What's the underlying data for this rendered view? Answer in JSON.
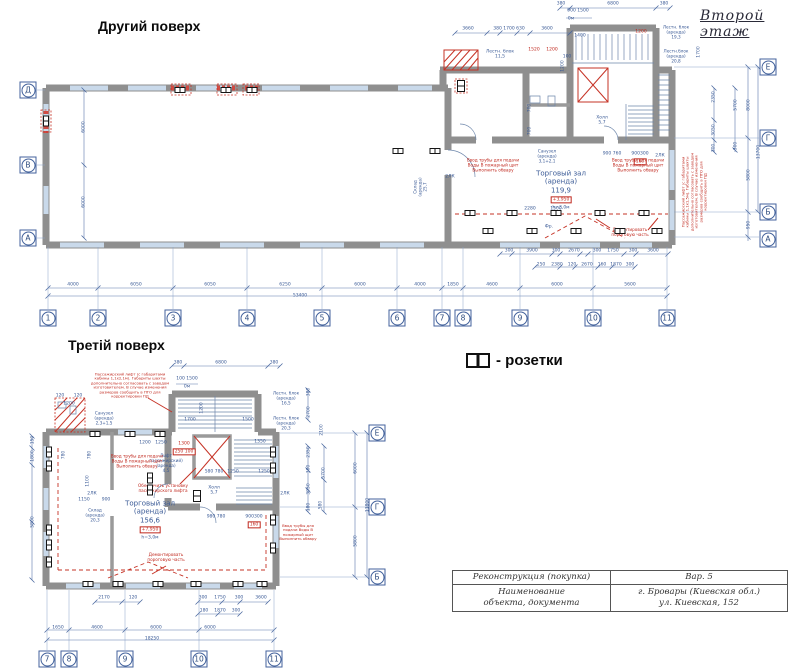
{
  "page": {
    "upper_title": "Другий поверх",
    "floor_note": "Второй этаж",
    "lower_title": "Третій поверх"
  },
  "legend": {
    "symbol": "socket-icon",
    "label": "- розетки"
  },
  "title_block": {
    "doc_type": "Реконструкция (покупка)",
    "doc_caption_1": "Наименование",
    "doc_caption_2": "объекта, документа",
    "variant": "Вар. 5",
    "address_1": "г. Бровары (Киевская обл.)",
    "address_2": "ул. Киевская, 152"
  },
  "colors": {
    "dim_blue": "#3a5a96",
    "annotation_red": "#c0281e",
    "wall_gray": "#8f8f8f",
    "window_blue": "#c9d9ea"
  },
  "axes": [
    {
      "l": "Д",
      "x": 28,
      "y": 90
    },
    {
      "l": "В",
      "x": 28,
      "y": 165
    },
    {
      "l": "А",
      "x": 28,
      "y": 238
    },
    {
      "l": "Е",
      "x": 768,
      "y": 67
    },
    {
      "l": "Г",
      "x": 768,
      "y": 138
    },
    {
      "l": "Б",
      "x": 768,
      "y": 212
    },
    {
      "l": "А",
      "x": 768,
      "y": 239
    },
    {
      "l": "1",
      "x": 48,
      "y": 318
    },
    {
      "l": "2",
      "x": 98,
      "y": 318
    },
    {
      "l": "3",
      "x": 173,
      "y": 318
    },
    {
      "l": "4",
      "x": 247,
      "y": 318
    },
    {
      "l": "5",
      "x": 322,
      "y": 318
    },
    {
      "l": "6",
      "x": 397,
      "y": 318
    },
    {
      "l": "7",
      "x": 442,
      "y": 318
    },
    {
      "l": "8",
      "x": 463,
      "y": 318
    },
    {
      "l": "9",
      "x": 520,
      "y": 318
    },
    {
      "l": "10",
      "x": 593,
      "y": 318
    },
    {
      "l": "11",
      "x": 667,
      "y": 318
    },
    {
      "l": "Е",
      "x": 377,
      "y": 433
    },
    {
      "l": "Г",
      "x": 377,
      "y": 507
    },
    {
      "l": "Б",
      "x": 377,
      "y": 577
    },
    {
      "l": "7",
      "x": 47,
      "y": 659
    },
    {
      "l": "8",
      "x": 69,
      "y": 659
    },
    {
      "l": "9",
      "x": 125,
      "y": 659
    },
    {
      "l": "10",
      "x": 199,
      "y": 659
    },
    {
      "l": "11",
      "x": 274,
      "y": 659
    }
  ],
  "sockets": [
    {
      "x": 180,
      "y": 90
    },
    {
      "x": 226,
      "y": 90
    },
    {
      "x": 252,
      "y": 90
    },
    {
      "x": 46,
      "y": 121,
      "r": 90
    },
    {
      "x": 398,
      "y": 151
    },
    {
      "x": 435,
      "y": 151
    },
    {
      "x": 461,
      "y": 86,
      "r": 90,
      "b": 1
    },
    {
      "x": 470,
      "y": 213
    },
    {
      "x": 512,
      "y": 213
    },
    {
      "x": 556,
      "y": 213
    },
    {
      "x": 600,
      "y": 213
    },
    {
      "x": 644,
      "y": 213
    },
    {
      "x": 488,
      "y": 231
    },
    {
      "x": 532,
      "y": 231
    },
    {
      "x": 576,
      "y": 231
    },
    {
      "x": 620,
      "y": 231
    },
    {
      "x": 657,
      "y": 231
    },
    {
      "x": 95,
      "y": 434
    },
    {
      "x": 130,
      "y": 434
    },
    {
      "x": 160,
      "y": 434
    },
    {
      "x": 49,
      "y": 452,
      "r": 90
    },
    {
      "x": 49,
      "y": 466,
      "r": 90
    },
    {
      "x": 49,
      "y": 530,
      "r": 90
    },
    {
      "x": 49,
      "y": 545,
      "r": 90
    },
    {
      "x": 49,
      "y": 562,
      "r": 90
    },
    {
      "x": 88,
      "y": 584
    },
    {
      "x": 118,
      "y": 584
    },
    {
      "x": 158,
      "y": 584
    },
    {
      "x": 196,
      "y": 584
    },
    {
      "x": 238,
      "y": 584
    },
    {
      "x": 262,
      "y": 584
    },
    {
      "x": 273,
      "y": 452,
      "r": 90
    },
    {
      "x": 273,
      "y": 468,
      "r": 90
    },
    {
      "x": 273,
      "y": 520,
      "r": 90
    },
    {
      "x": 273,
      "y": 548,
      "r": 90
    },
    {
      "x": 197,
      "y": 496,
      "r": 90,
      "b": 1
    },
    {
      "x": 150,
      "y": 478,
      "r": 90
    },
    {
      "x": 150,
      "y": 490,
      "r": 90
    }
  ],
  "labels": [
    {
      "t": "900 1500",
      "x": 578,
      "y": 11
    },
    {
      "t": "0м",
      "x": 571,
      "y": 19
    },
    {
      "t": "380",
      "x": 561,
      "y": 4
    },
    {
      "t": "6800",
      "x": 613,
      "y": 4
    },
    {
      "t": "380",
      "x": 664,
      "y": 4
    },
    {
      "t": "3660",
      "x": 468,
      "y": 29
    },
    {
      "t": "380 1700 630",
      "x": 509,
      "y": 29
    },
    {
      "t": "3600",
      "x": 547,
      "y": 29
    },
    {
      "t": "1400",
      "x": 580,
      "y": 36
    },
    {
      "t": "1520",
      "x": 534,
      "y": 50,
      "c": "r"
    },
    {
      "t": "1200",
      "x": 552,
      "y": 50,
      "c": "r"
    },
    {
      "t": "100",
      "x": 567,
      "y": 57
    },
    {
      "t": "1200",
      "x": 563,
      "y": 66,
      "r": -90
    },
    {
      "t": "1200",
      "x": 641,
      "y": 32,
      "c": "r"
    },
    {
      "t": "1700",
      "x": 699,
      "y": 52,
      "r": -90
    },
    {
      "t": "Лестн. блок\n11,5",
      "x": 500,
      "y": 55,
      "n": "room-label"
    },
    {
      "t": "Лестн. блок\n(аренда)\n19,3",
      "x": 676,
      "y": 33,
      "s": 4.2,
      "n": "room-label"
    },
    {
      "t": "Лестн.блок\n(аренда)\n20,8",
      "x": 676,
      "y": 57,
      "s": 4.2,
      "n": "room-label"
    },
    {
      "t": "700",
      "x": 530,
      "y": 108,
      "r": -90
    },
    {
      "t": "700",
      "x": 530,
      "y": 131,
      "r": -90
    },
    {
      "t": "Санузел\n(аренда)\n3,1+2,1",
      "x": 547,
      "y": 157,
      "s": 4.2,
      "n": "room-label"
    },
    {
      "t": "Холл\n5,7",
      "x": 602,
      "y": 121,
      "n": "room-label"
    },
    {
      "t": "Торговый зал\n(аренда)\n119,9",
      "x": 561,
      "y": 182,
      "s": 7,
      "n": "room-label"
    },
    {
      "t": "+3,950",
      "x": 561,
      "y": 200,
      "c": "r",
      "box": 1
    },
    {
      "t": "h=3,0м",
      "x": 561,
      "y": 208
    },
    {
      "t": "Склад\n(аренда)\n25,7",
      "x": 421,
      "y": 187,
      "r": -90,
      "s": 4.2,
      "n": "room-label"
    },
    {
      "t": "2ЛК",
      "x": 450,
      "y": 177
    },
    {
      "t": "900 760",
      "x": 612,
      "y": 154
    },
    {
      "t": "900300",
      "x": 640,
      "y": 154
    },
    {
      "t": "160",
      "x": 640,
      "y": 162,
      "c": "r",
      "box": 1
    },
    {
      "t": "2ЛК",
      "x": 660,
      "y": 156
    },
    {
      "t": "2280",
      "x": 530,
      "y": 209
    },
    {
      "t": "1500",
      "x": 556,
      "y": 209
    },
    {
      "t": "Фр.",
      "x": 549,
      "y": 227
    },
    {
      "t": "Ввод трубы для подачи\nВоды В пожарный щит\nВыполнить обвару",
      "x": 493,
      "y": 166,
      "c": "r",
      "s": 4.2,
      "n": "annotation"
    },
    {
      "t": "Ввод трубы для подачи\nВоды В пожарный щит\nВыполнить обвару",
      "x": 638,
      "y": 166,
      "c": "r",
      "s": 4.2,
      "n": "annotation"
    },
    {
      "t": "Демонтировать\nпороговую часть",
      "x": 630,
      "y": 233,
      "c": "r",
      "s": 4.2,
      "n": "annotation"
    },
    {
      "t": "Пассажирский лифт (с габаритами\nкабины 1,1х1,5м). Габариты шахты\nдополнительно согласовать с заводом\nизготовителем. В случае изменения\nразмеров сообщить в ПТО для\nкорректировки ПД",
      "x": 695,
      "y": 192,
      "c": "r",
      "s": 3.8,
      "r": -90,
      "n": "annotation"
    },
    {
      "t": "300",
      "x": 509,
      "y": 251
    },
    {
      "t": "3900",
      "x": 532,
      "y": 251
    },
    {
      "t": "300",
      "x": 556,
      "y": 251
    },
    {
      "t": "2670",
      "x": 574,
      "y": 251
    },
    {
      "t": "300",
      "x": 597,
      "y": 251
    },
    {
      "t": "1750",
      "x": 613,
      "y": 251
    },
    {
      "t": "300",
      "x": 633,
      "y": 251
    },
    {
      "t": "3600",
      "x": 653,
      "y": 251
    },
    {
      "t": "250",
      "x": 541,
      "y": 265
    },
    {
      "t": "2380",
      "x": 557,
      "y": 265
    },
    {
      "t": "120",
      "x": 572,
      "y": 265
    },
    {
      "t": "2670",
      "x": 587,
      "y": 265
    },
    {
      "t": "160",
      "x": 602,
      "y": 265
    },
    {
      "t": "1870",
      "x": 616,
      "y": 265
    },
    {
      "t": "300",
      "x": 630,
      "y": 265
    },
    {
      "t": "4000",
      "x": 73,
      "y": 285
    },
    {
      "t": "6050",
      "x": 136,
      "y": 285
    },
    {
      "t": "6050",
      "x": 210,
      "y": 285
    },
    {
      "t": "6250",
      "x": 285,
      "y": 285
    },
    {
      "t": "6000",
      "x": 360,
      "y": 285
    },
    {
      "t": "4000",
      "x": 420,
      "y": 285
    },
    {
      "t": "1850",
      "x": 453,
      "y": 285
    },
    {
      "t": "4600",
      "x": 492,
      "y": 285
    },
    {
      "t": "6000",
      "x": 557,
      "y": 285
    },
    {
      "t": "5600",
      "x": 630,
      "y": 285
    },
    {
      "t": "53400",
      "x": 300,
      "y": 296
    },
    {
      "t": "6000",
      "x": 84,
      "y": 127,
      "r": -90
    },
    {
      "t": "6000",
      "x": 84,
      "y": 202,
      "r": -90
    },
    {
      "t": "5700",
      "x": 736,
      "y": 105,
      "r": -90
    },
    {
      "t": "300",
      "x": 736,
      "y": 146,
      "r": -90
    },
    {
      "t": "8000",
      "x": 749,
      "y": 105,
      "r": -90
    },
    {
      "t": "13700",
      "x": 759,
      "y": 152,
      "r": -90
    },
    {
      "t": "5800",
      "x": 749,
      "y": 175,
      "r": -90
    },
    {
      "t": "950",
      "x": 749,
      "y": 225,
      "r": -90
    },
    {
      "t": "2350",
      "x": 714,
      "y": 97,
      "r": -90
    },
    {
      "t": "3050",
      "x": 714,
      "y": 130,
      "r": -90
    },
    {
      "t": "300",
      "x": 714,
      "y": 148,
      "r": -90
    },
    {
      "t": "380",
      "x": 178,
      "y": 363
    },
    {
      "t": "6800",
      "x": 221,
      "y": 363
    },
    {
      "t": "380",
      "x": 274,
      "y": 363
    },
    {
      "t": "100 1500",
      "x": 187,
      "y": 379
    },
    {
      "t": "0м",
      "x": 187,
      "y": 387
    },
    {
      "t": "120",
      "x": 60,
      "y": 396
    },
    {
      "t": "120",
      "x": 78,
      "y": 396
    },
    {
      "t": "1200",
      "x": 69,
      "y": 404
    },
    {
      "t": "Санузел\n(аренда)\n2,3+1,5",
      "x": 104,
      "y": 419,
      "s": 4.2,
      "n": "room-label"
    },
    {
      "t": "Лестн. блок\n(аренда)\n16,5",
      "x": 286,
      "y": 399,
      "s": 4.2,
      "n": "room-label"
    },
    {
      "t": "Лестн. блок\n(аренда)\n20,3",
      "x": 286,
      "y": 424,
      "s": 4.2,
      "n": "room-label"
    },
    {
      "t": "1200",
      "x": 202,
      "y": 408,
      "r": -90
    },
    {
      "t": "1700",
      "x": 190,
      "y": 420
    },
    {
      "t": "1500",
      "x": 248,
      "y": 420
    },
    {
      "t": "1200",
      "x": 145,
      "y": 443
    },
    {
      "t": "1250",
      "x": 161,
      "y": 443
    },
    {
      "t": "1300",
      "x": 184,
      "y": 444,
      "c": "r"
    },
    {
      "t": "250 100",
      "x": 184,
      "y": 452,
      "c": "r",
      "box": 1
    },
    {
      "t": "1350",
      "x": 260,
      "y": 442
    },
    {
      "t": "780",
      "x": 64,
      "y": 455,
      "r": -90
    },
    {
      "t": "780",
      "x": 90,
      "y": 455,
      "r": -90
    },
    {
      "t": "1100",
      "x": 88,
      "y": 481,
      "r": -90
    },
    {
      "t": "Лифт\nпассажирский)\n(аренда)\n4,5",
      "x": 166,
      "y": 464,
      "s": 4.2,
      "n": "room-label"
    },
    {
      "t": "Холл\n5,7",
      "x": 214,
      "y": 491,
      "n": "room-label"
    },
    {
      "t": "580 780",
      "x": 214,
      "y": 472
    },
    {
      "t": "1250",
      "x": 233,
      "y": 472
    },
    {
      "t": "1250",
      "x": 264,
      "y": 472
    },
    {
      "t": "1150",
      "x": 84,
      "y": 500
    },
    {
      "t": "900",
      "x": 106,
      "y": 500
    },
    {
      "t": "Склад\n(аренда)\n20,3",
      "x": 95,
      "y": 516,
      "s": 4.2,
      "n": "room-label"
    },
    {
      "t": "Торговый зал\n(аренда)\n156,6",
      "x": 150,
      "y": 512,
      "s": 7,
      "n": "room-label"
    },
    {
      "t": "+7,950",
      "x": 150,
      "y": 530,
      "c": "r",
      "box": 1
    },
    {
      "t": "h=3,0м",
      "x": 150,
      "y": 538
    },
    {
      "t": "980 780",
      "x": 216,
      "y": 517
    },
    {
      "t": "900300",
      "x": 254,
      "y": 517
    },
    {
      "t": "160",
      "x": 254,
      "y": 525,
      "c": "r",
      "box": 1
    },
    {
      "t": "2ЛК",
      "x": 285,
      "y": 494
    },
    {
      "t": "2ЛК",
      "x": 92,
      "y": 494
    },
    {
      "t": "Пассажирский лифт (с габаритами\nкабины 1,1х2,1м). Габариты шахты\nдополнительно согласовать с заводом\nизготовителем. В случае изменения\nразмеров сообщить в ПТО для\nкорректировки ПД",
      "x": 130,
      "y": 386,
      "c": "r",
      "s": 3.8,
      "n": "annotation"
    },
    {
      "t": "Ввод трубы для подачи\nВоды В пожарный щит\nВыполнить обвару",
      "x": 137,
      "y": 462,
      "c": "r",
      "s": 4.2,
      "n": "annotation"
    },
    {
      "t": "Обеспечить установку\nпассажирского лифта",
      "x": 163,
      "y": 489,
      "c": "r",
      "s": 4.2,
      "n": "annotation"
    },
    {
      "t": "Демонтировать\nпороговую часть",
      "x": 166,
      "y": 558,
      "c": "r",
      "s": 4.2,
      "n": "annotation"
    },
    {
      "t": "Ввод трубы для\nподачи Воды В\nпожарный щит\nВыполнить обвару",
      "x": 298,
      "y": 533,
      "c": "r",
      "s": 3.8,
      "n": "annotation"
    },
    {
      "t": "380",
      "x": 309,
      "y": 392,
      "r": -90
    },
    {
      "t": "2700",
      "x": 309,
      "y": 412,
      "r": -90
    },
    {
      "t": "2350",
      "x": 309,
      "y": 452,
      "r": -90
    },
    {
      "t": "300",
      "x": 309,
      "y": 469,
      "r": -90
    },
    {
      "t": "3050",
      "x": 309,
      "y": 489,
      "r": -90
    },
    {
      "t": "180",
      "x": 309,
      "y": 507,
      "r": -90
    },
    {
      "t": "2100",
      "x": 322,
      "y": 430,
      "r": -90
    },
    {
      "t": "5700",
      "x": 324,
      "y": 473,
      "r": -90
    },
    {
      "t": "580",
      "x": 321,
      "y": 505,
      "r": -90
    },
    {
      "t": "6000",
      "x": 356,
      "y": 468,
      "r": -90
    },
    {
      "t": "5800",
      "x": 356,
      "y": 541,
      "r": -90
    },
    {
      "t": "11800",
      "x": 368,
      "y": 505,
      "r": -90
    },
    {
      "t": "150",
      "x": 33,
      "y": 440,
      "r": -90
    },
    {
      "t": "1800",
      "x": 33,
      "y": 456,
      "r": -90
    },
    {
      "t": "5800",
      "x": 33,
      "y": 522,
      "r": -90
    },
    {
      "t": "2170",
      "x": 104,
      "y": 598
    },
    {
      "t": "120",
      "x": 133,
      "y": 598
    },
    {
      "t": "300",
      "x": 203,
      "y": 598
    },
    {
      "t": "1750",
      "x": 220,
      "y": 598
    },
    {
      "t": "300",
      "x": 239,
      "y": 598
    },
    {
      "t": "3600",
      "x": 261,
      "y": 598
    },
    {
      "t": "180",
      "x": 204,
      "y": 611
    },
    {
      "t": "1870",
      "x": 220,
      "y": 611
    },
    {
      "t": "300",
      "x": 236,
      "y": 611
    },
    {
      "t": "1650",
      "x": 58,
      "y": 628
    },
    {
      "t": "4600",
      "x": 97,
      "y": 628
    },
    {
      "t": "6000",
      "x": 156,
      "y": 628
    },
    {
      "t": "6000",
      "x": 210,
      "y": 628
    },
    {
      "t": "18250",
      "x": 152,
      "y": 639
    }
  ]
}
